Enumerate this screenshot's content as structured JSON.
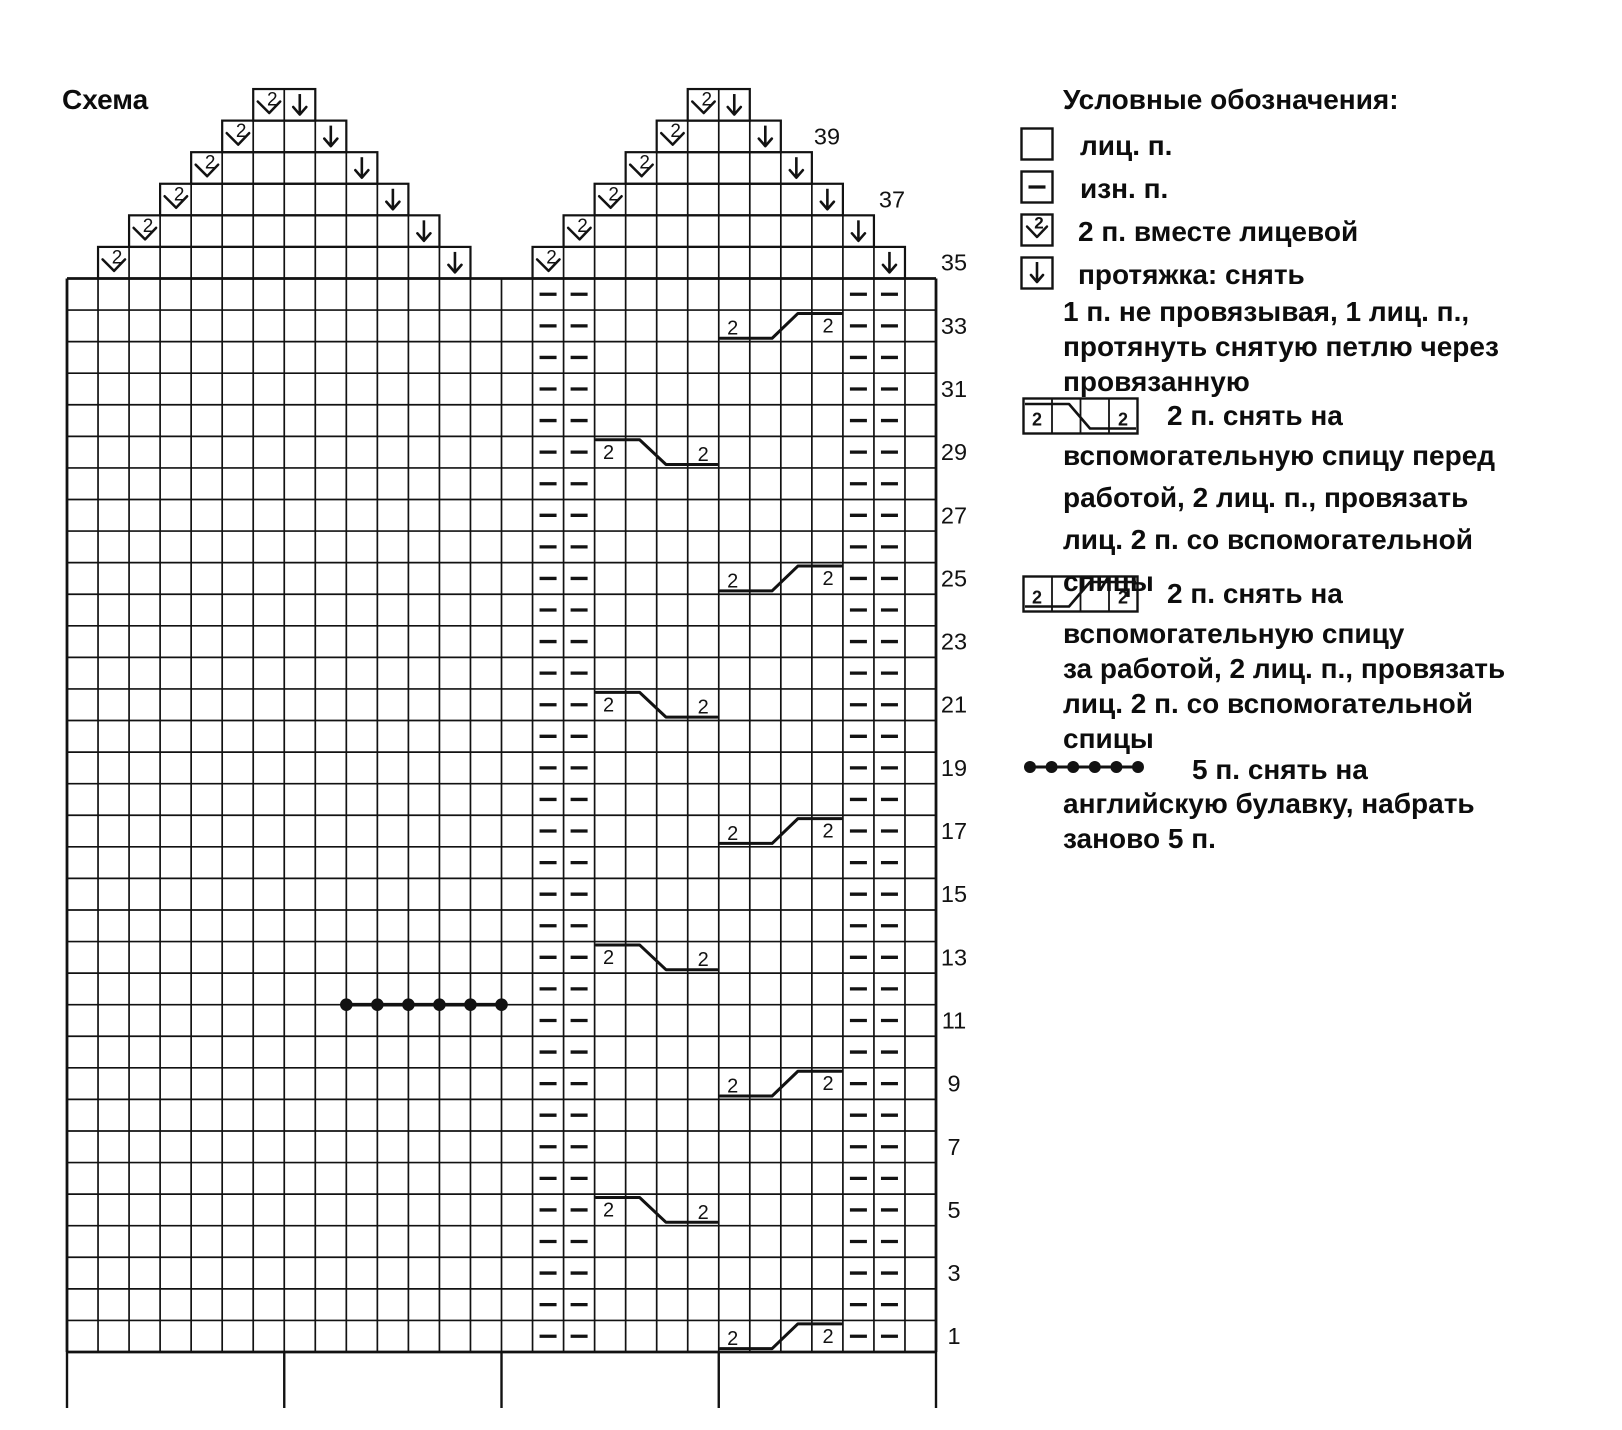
{
  "title": "Схема",
  "colors": {
    "ink": "#121212",
    "paper": "#ffffff"
  },
  "legend": {
    "title": "Условные обозначения:",
    "items": [
      {
        "symbol": "knit-square",
        "lines": [
          "лиц. п."
        ]
      },
      {
        "symbol": "purl-square",
        "lines": [
          "изн. п."
        ]
      },
      {
        "symbol": "k2tog-square",
        "lines": [
          "2 п. вместе лицевой"
        ]
      },
      {
        "symbol": "slip-arrow-square",
        "lines": [
          "протяжка: снять",
          "1 п. не провязывая, 1 лиц. п.,",
          "протянуть снятую петлю через",
          "провязанную"
        ]
      },
      {
        "symbol": "cable-front",
        "lines": [
          "2 п. снять на",
          "вспомогательную спицу перед",
          "работой, 2 лиц. п., провязать",
          "лиц. 2 п. со вспомогательной",
          "спицы"
        ]
      },
      {
        "symbol": "cable-back",
        "lines": [
          "2 п. снять на",
          "вспомогательную спицу",
          "за работой, 2 лиц. п., провязать",
          "лиц. 2 п. со вспомогательной",
          "спицы"
        ]
      },
      {
        "symbol": "safety-pin-dots",
        "lines": [
          "5 п. снять на",
          "английскую булавку, набрать",
          "заново 5 п."
        ]
      }
    ]
  },
  "chart_data": {
    "type": "knitting-chart",
    "columns": 28,
    "rows_main": 34,
    "rows_total": 40,
    "stitch_key": {
      "empty": "knit (лиц. п.)",
      "dash": "purl (изн. п.)"
    },
    "row_labels": [
      39,
      37,
      35,
      33,
      31,
      29,
      27,
      25,
      23,
      21,
      19,
      17,
      15,
      13,
      11,
      9,
      7,
      5,
      3,
      1
    ],
    "purl_columns": [
      16,
      17,
      26,
      27
    ],
    "symbols": {
      "k2tog_label": "2",
      "cable_label": "2"
    },
    "triangles": [
      {
        "side": "left",
        "rows": [
          {
            "row": 40,
            "k2tog_col": 7,
            "slip_col": 8
          },
          {
            "row": 39,
            "k2tog_col": 6,
            "slip_col": 9
          },
          {
            "row": 38,
            "k2tog_col": 5,
            "slip_col": 10
          },
          {
            "row": 37,
            "k2tog_col": 4,
            "slip_col": 11
          },
          {
            "row": 36,
            "k2tog_col": 3,
            "slip_col": 12
          },
          {
            "row": 35,
            "k2tog_col": 2,
            "slip_col": 13
          }
        ]
      },
      {
        "side": "right",
        "rows": [
          {
            "row": 40,
            "k2tog_col": 21,
            "slip_col": 22
          },
          {
            "row": 39,
            "k2tog_col": 20,
            "slip_col": 23
          },
          {
            "row": 38,
            "k2tog_col": 19,
            "slip_col": 24
          },
          {
            "row": 37,
            "k2tog_col": 18,
            "slip_col": 25
          },
          {
            "row": 36,
            "k2tog_col": 17,
            "slip_col": 26
          },
          {
            "row": 35,
            "k2tog_col": 16,
            "slip_col": 27
          }
        ]
      }
    ],
    "cables": [
      {
        "row": 33,
        "start_col": 22,
        "type": "back"
      },
      {
        "row": 29,
        "start_col": 18,
        "type": "front"
      },
      {
        "row": 25,
        "start_col": 22,
        "type": "back"
      },
      {
        "row": 21,
        "start_col": 18,
        "type": "front"
      },
      {
        "row": 17,
        "start_col": 22,
        "type": "back"
      },
      {
        "row": 13,
        "start_col": 18,
        "type": "front"
      },
      {
        "row": 9,
        "start_col": 22,
        "type": "back"
      },
      {
        "row": 5,
        "start_col": 18,
        "type": "front"
      },
      {
        "row": 1,
        "start_col": 22,
        "type": "back"
      }
    ],
    "safety_pin_marker": {
      "above_row": 11,
      "start_col": 10,
      "end_col": 14,
      "dots": 6
    },
    "repeat_ticks_cols": [
      0,
      7,
      14,
      21,
      28
    ]
  }
}
